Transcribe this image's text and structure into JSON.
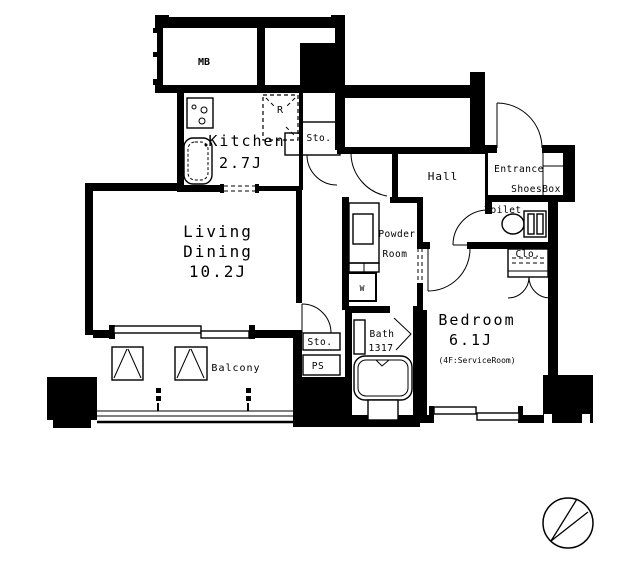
{
  "plan": {
    "rooms": {
      "mb": {
        "label": "MB"
      },
      "kitchen": {
        "label": "Kitchen",
        "size": "2.7J"
      },
      "kitchen_storage": {
        "label": "Sto."
      },
      "refrigerator": {
        "label": "R"
      },
      "living_dining": {
        "line1": "Living",
        "line2": "Dining",
        "size": "10.2J"
      },
      "hall": {
        "label": "Hall"
      },
      "entrance": {
        "label": "Entrance"
      },
      "shoes_box": {
        "label": "ShoesBox"
      },
      "toilet": {
        "label": "Toilet"
      },
      "closet": {
        "label": "Clo."
      },
      "powder_room": {
        "line1": "Powder",
        "line2": "Room"
      },
      "washing_machine": {
        "label": "W"
      },
      "bath": {
        "label": "Bath",
        "size": "1317"
      },
      "bedroom": {
        "label": "Bedroom",
        "size": "6.1J",
        "note": "(4F:ServiceRoom)"
      },
      "balcony": {
        "label": "Balcony"
      },
      "balcony_storage": {
        "label": "Sto."
      },
      "pipe_space": {
        "label": "PS"
      }
    },
    "icons": {
      "compass": "compass-north-icon",
      "bathtub": "bathtub-icon",
      "toilet_bowl": "toilet-icon",
      "stove": "stove-icon",
      "sink": "kitchen-sink-icon"
    },
    "colors": {
      "wall": "#000000",
      "background": "#ffffff"
    }
  }
}
